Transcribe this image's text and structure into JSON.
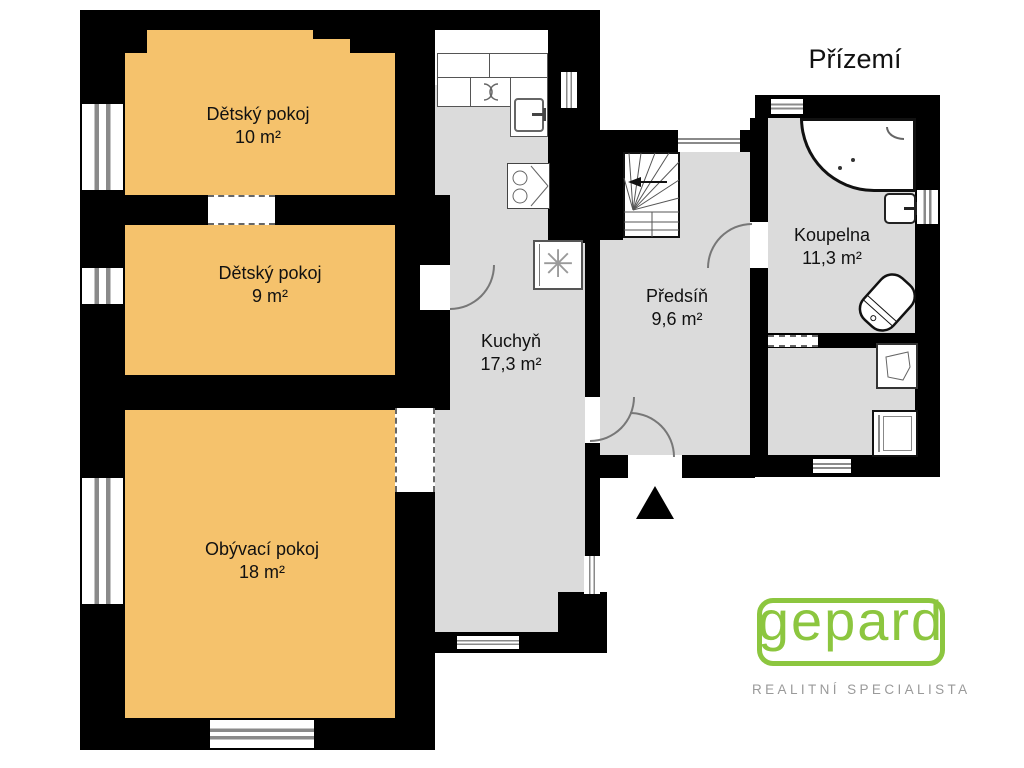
{
  "title": "Přízemí",
  "rooms": [
    {
      "id": "detsky-pokoj-1",
      "name": "Dětský pokoj",
      "area": "10 m²",
      "fill": "#F5C26C"
    },
    {
      "id": "detsky-pokoj-2",
      "name": "Dětský pokoj",
      "area": "9 m²",
      "fill": "#F5C26C"
    },
    {
      "id": "obyvaci-pokoj",
      "name": "Obývací pokoj",
      "area": "18 m²",
      "fill": "#F5C26C"
    },
    {
      "id": "kuchyn",
      "name": "Kuchyň",
      "area": "17,3 m²",
      "fill": "#DBDBDB"
    },
    {
      "id": "predsin",
      "name": "Předsíň",
      "area": "9,6 m²",
      "fill": "#DBDBDB"
    },
    {
      "id": "koupelna",
      "name": "Koupelna",
      "area": "11,3 m²",
      "fill": "#DBDBDB"
    }
  ],
  "fixtures": [
    "bathtub",
    "toilet",
    "bathroom-sink",
    "utility-sink",
    "washing-machine",
    "stairs",
    "kitchen-counter",
    "kitchen-sink",
    "cooktop",
    "stove",
    "entrance-arrow"
  ],
  "logo": {
    "brand": "gepard",
    "tagline": "REALITNÍ SPECIALISTA",
    "accent_green": "#8CC63F",
    "tagline_gray": "#9A9A9A"
  },
  "colors": {
    "wall": "#000000",
    "room_warm": "#F5C26C",
    "room_cool": "#DBDBDB",
    "stove_symbol": "✳"
  }
}
